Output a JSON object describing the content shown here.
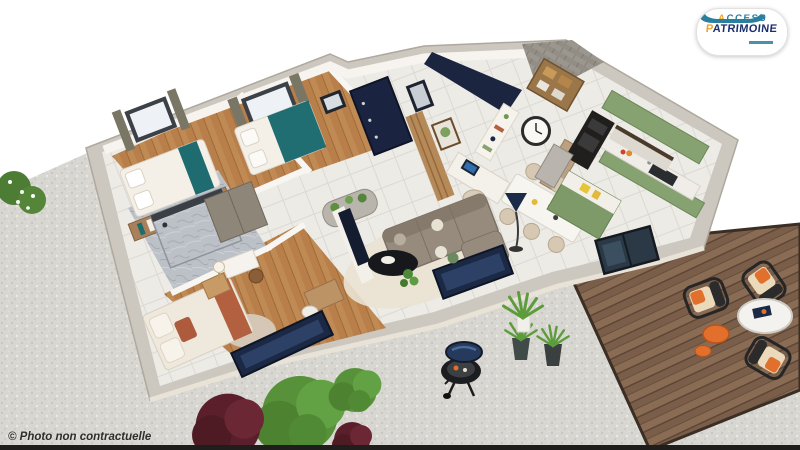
{
  "branding": {
    "logo": {
      "word1_initial": "A",
      "word1_rest": "CCESS",
      "word2_initial": "P",
      "word2_rest": "ATRIMOINE",
      "accent_color": "#f0a22e",
      "word1_color": "#2a7f9e",
      "word2_color": "#1c2f6d",
      "hand_color": "#2a7f9e",
      "badge_bg": "#ffffff"
    }
  },
  "watermark": {
    "text": "© Photo non contractuelle",
    "color": "#2e2d29"
  },
  "scene": {
    "type": "3d-floorplan-render",
    "features": [
      "bedroom-white-bed",
      "bedroom-teal-bed",
      "bathroom-marble-shower",
      "bedroom-master",
      "entry-navy-door",
      "office-nook",
      "wall-clock",
      "living-room-sofa",
      "coffee-table",
      "dining-table",
      "kitchen-green-cabinets",
      "kitchen-island",
      "terrace-glass-door",
      "wood-deck",
      "deck-chairs",
      "deck-round-table",
      "barbecue-grill",
      "gravel-yard",
      "garden-bushes",
      "potted-grasses"
    ],
    "palette": {
      "background": "#ffffff",
      "gravel": "#d8d6d1",
      "deck_wood": "#7a5e49",
      "wall_concrete": "#ccc7bf",
      "interior_wall": "#f7f4ef",
      "wood_floor": "#c08a54",
      "tile_floor": "#edebe6",
      "bath_marble": "#bcc1c7",
      "kitchen_green": "#87a271",
      "accent_navy": "#1b2945",
      "teal_bedding": "#1e6b70",
      "terracotta": "#ad5a3d",
      "sofa_gray": "#968b7c",
      "chair_beige": "#d6c8b2",
      "cushion_orange": "#e0702c",
      "plant_green": "#57923a",
      "plant_burgundy": "#5a1f2b",
      "bottom_strip": "#1f1e1c"
    }
  }
}
